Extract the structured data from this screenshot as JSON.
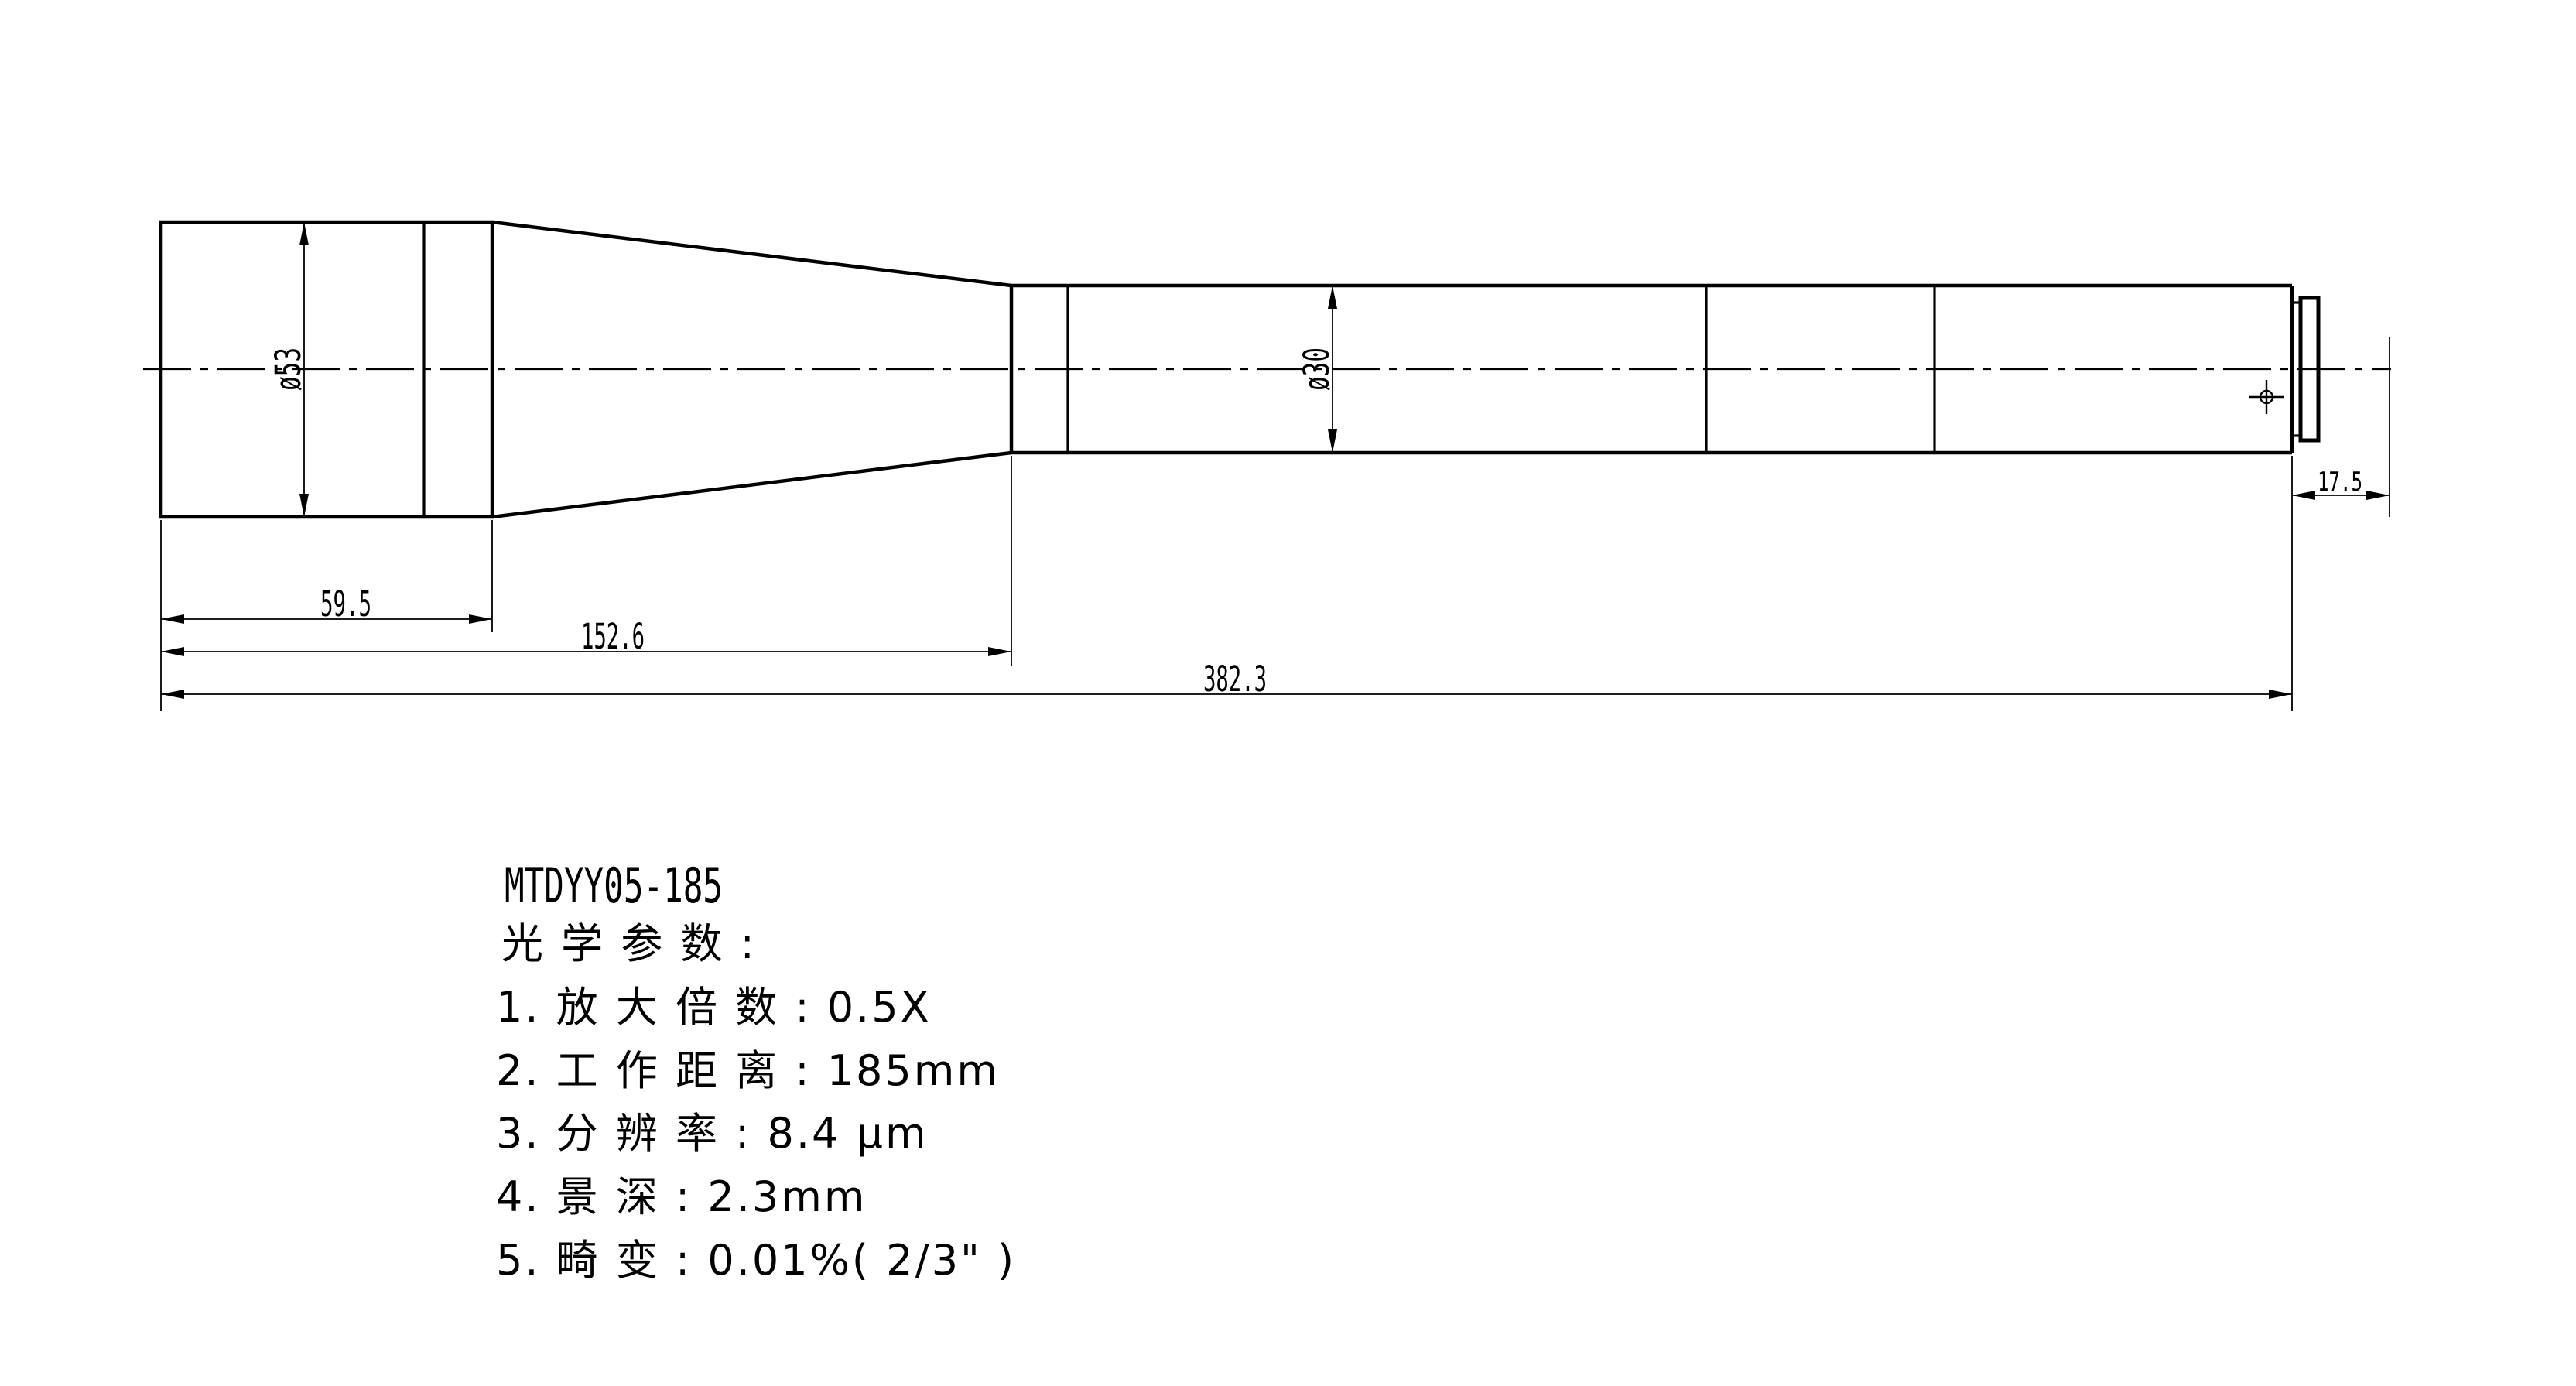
{
  "drawing": {
    "part_number": "MTDYY05-185",
    "dimensions": {
      "rear_diameter": "ø53",
      "tube_diameter": "ø30",
      "rear_length": "59.5",
      "mid_length": "152.6",
      "total_length": "382.3",
      "flange_length": "17.5"
    },
    "notes": {
      "heading": "光 学 参 数 :",
      "items": [
        "1. 放 大 倍 数 : 0.5X",
        "2. 工 作 距 离 : 185mm",
        "3. 分 辨 率 : 8.4 μm",
        "4. 景 深 : 2.3mm",
        "5. 畸 变 : 0.01%( 2/3\" )"
      ]
    },
    "colors": {
      "line": "#000000",
      "background": "#ffffff"
    }
  }
}
